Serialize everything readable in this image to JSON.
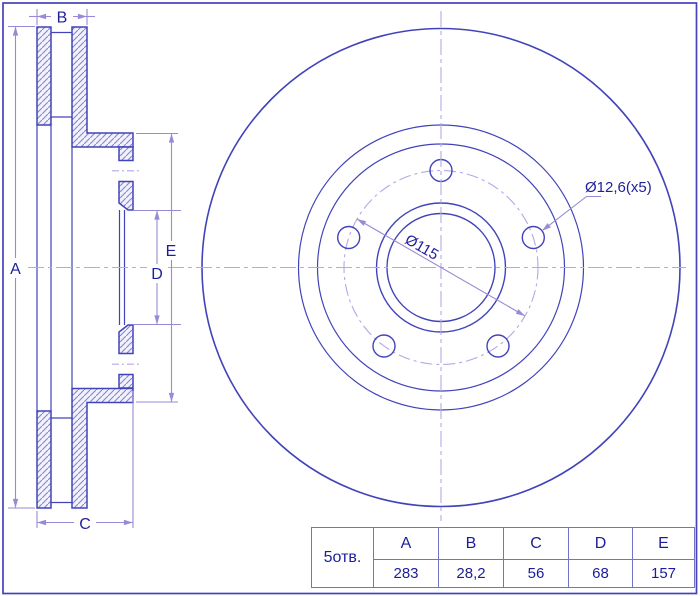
{
  "section_view": {
    "dim_labels": {
      "a": "A",
      "b": "B",
      "c": "C",
      "d": "D",
      "e": "E"
    }
  },
  "front_view": {
    "pcd_dim_label": "Ø115",
    "bolt_holes_label": "Ø12,6(x5)"
  },
  "spec_table": {
    "row_header": "5отв.",
    "columns": [
      "A",
      "B",
      "C",
      "D",
      "E"
    ],
    "values": [
      "283",
      "28,2",
      "56",
      "68",
      "157"
    ]
  },
  "colors": {
    "outline": "#4243ba",
    "hatch": "#8585d4",
    "dimension": "#998ad6",
    "centerline": "#b4a8e6",
    "text": "#1f1f9e",
    "table_border": "#7272c8"
  }
}
